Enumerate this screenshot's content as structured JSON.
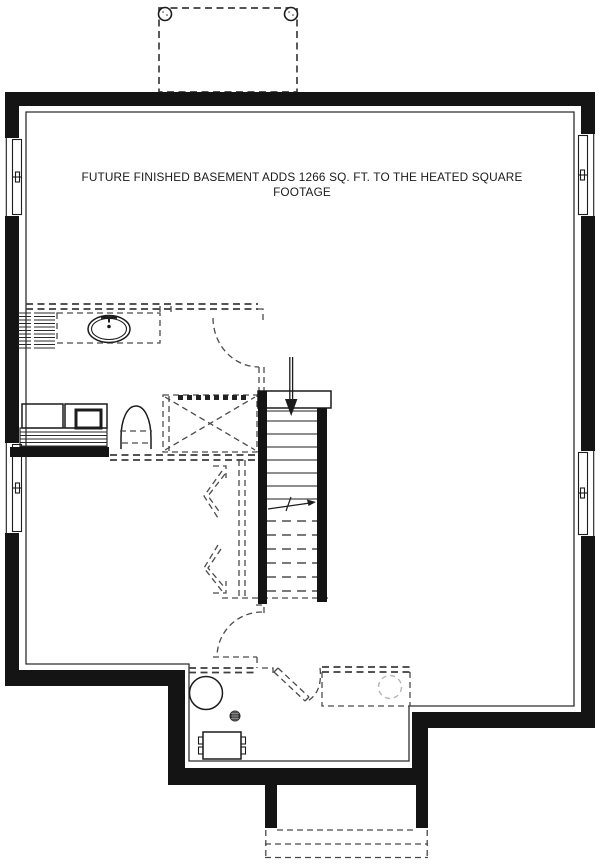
{
  "document": {
    "type": "basement-floor-plan"
  },
  "annotation": {
    "line1": "FUTURE FINISHED BASEMENT ADDS 1266 SQ. FT. TO THE HEATED SQUARE",
    "line2": "FOOTAGE"
  },
  "colors": {
    "background": "#ffffff",
    "wall": "#141414",
    "line": "#2e2e2e",
    "future_wall_dashed": "#3d3d3d",
    "hidden_step_dashed": "#7a7a7a",
    "light_dashed": "#b5b5b5"
  }
}
